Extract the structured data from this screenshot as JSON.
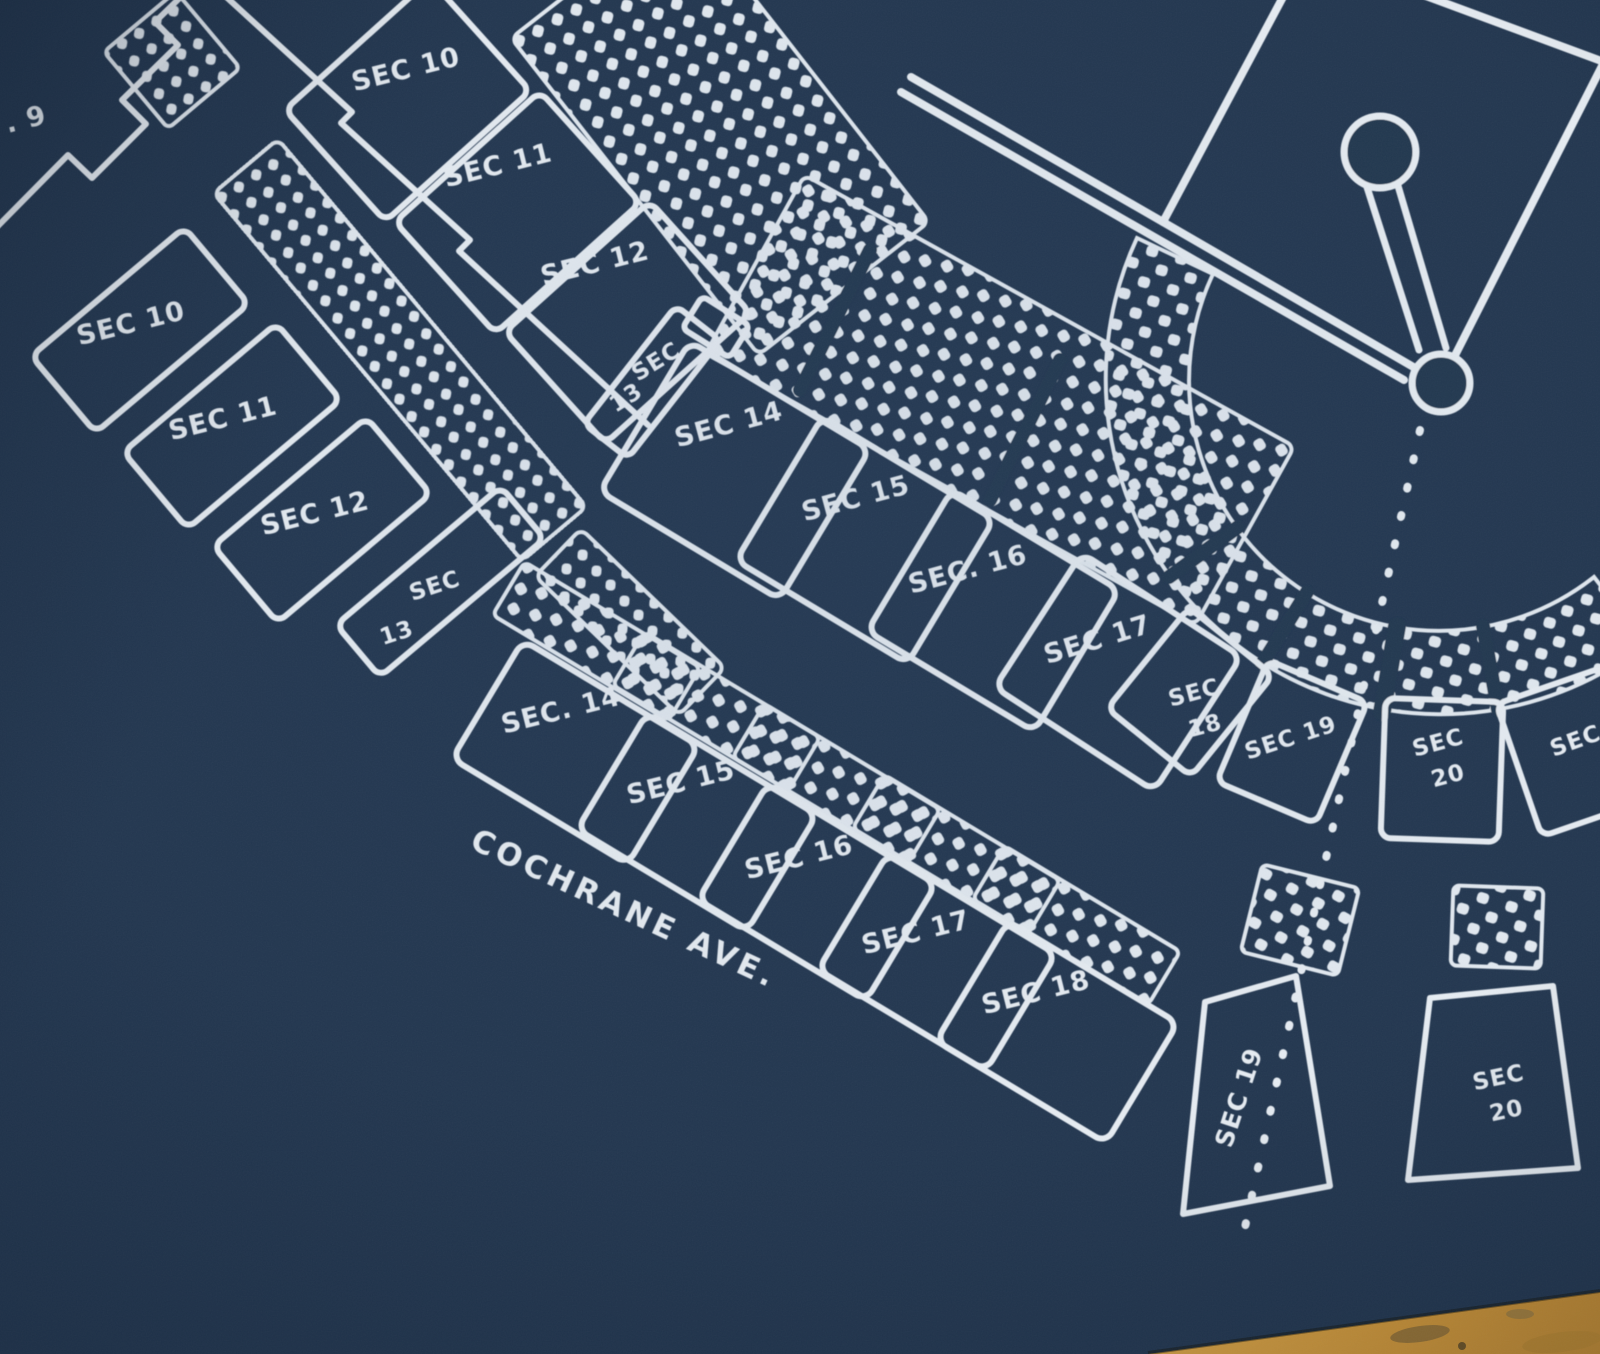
{
  "artwork": {
    "street": {
      "label": "COCHRANE AVE."
    },
    "sections": {
      "left_grandstand": [
        {
          "id": "sec-9",
          "label": ". 9"
        },
        {
          "id": "sec-10",
          "label": "SEC 10"
        },
        {
          "id": "sec-11",
          "label": "SEC 11"
        },
        {
          "id": "sec-12",
          "label": "SEC 12"
        },
        {
          "id": "sec-13",
          "line1": "SEC",
          "line2": "13"
        }
      ],
      "upper_deck_band": [
        {
          "id": "sec-10",
          "label": "SEC 10"
        },
        {
          "id": "sec-11",
          "label": "SEC 11"
        },
        {
          "id": "sec-12",
          "label": "SEC 12"
        }
      ],
      "infield_box_row": [
        {
          "id": "sec-13",
          "line1": "SEC",
          "line2": "13"
        },
        {
          "id": "sec-14",
          "label": "SEC 14"
        },
        {
          "id": "sec-15",
          "label": "SEC 15"
        },
        {
          "id": "sec-16",
          "label": "SEC. 16"
        },
        {
          "id": "sec-17",
          "label": "SEC 17"
        },
        {
          "id": "sec-18",
          "line1": "SEC",
          "line2": "18"
        },
        {
          "id": "sec-19",
          "label": "SEC 19"
        },
        {
          "id": "sec-20",
          "line1": "SEC",
          "line2": "20"
        },
        {
          "id": "sec-21",
          "label": "SEC"
        }
      ],
      "outer_box_row": [
        {
          "id": "sec-14",
          "label": "SEC. 14"
        },
        {
          "id": "sec-15",
          "label": "SEC 15"
        },
        {
          "id": "sec-16",
          "label": "SEC 16"
        },
        {
          "id": "sec-17",
          "label": "SEC 17"
        },
        {
          "id": "sec-18",
          "label": "SEC 18"
        }
      ],
      "rear_wedge_sections": [
        {
          "id": "sec-19",
          "label": "SEC 19"
        },
        {
          "id": "sec-20",
          "line1": "SEC",
          "line2": "20"
        }
      ]
    },
    "field_icons": [
      "infield-diamond",
      "pitchers-mound-keyhole",
      "home-plate-circle",
      "foul-line-double",
      "foul-line-dashed"
    ],
    "colors": {
      "paper_navy": "#233750",
      "ink_white": "#e7edf3",
      "vignette_navy": "#0a1626",
      "wood_tan": "#d39a3e",
      "wood_grain_brown": "#7c5f31"
    }
  }
}
